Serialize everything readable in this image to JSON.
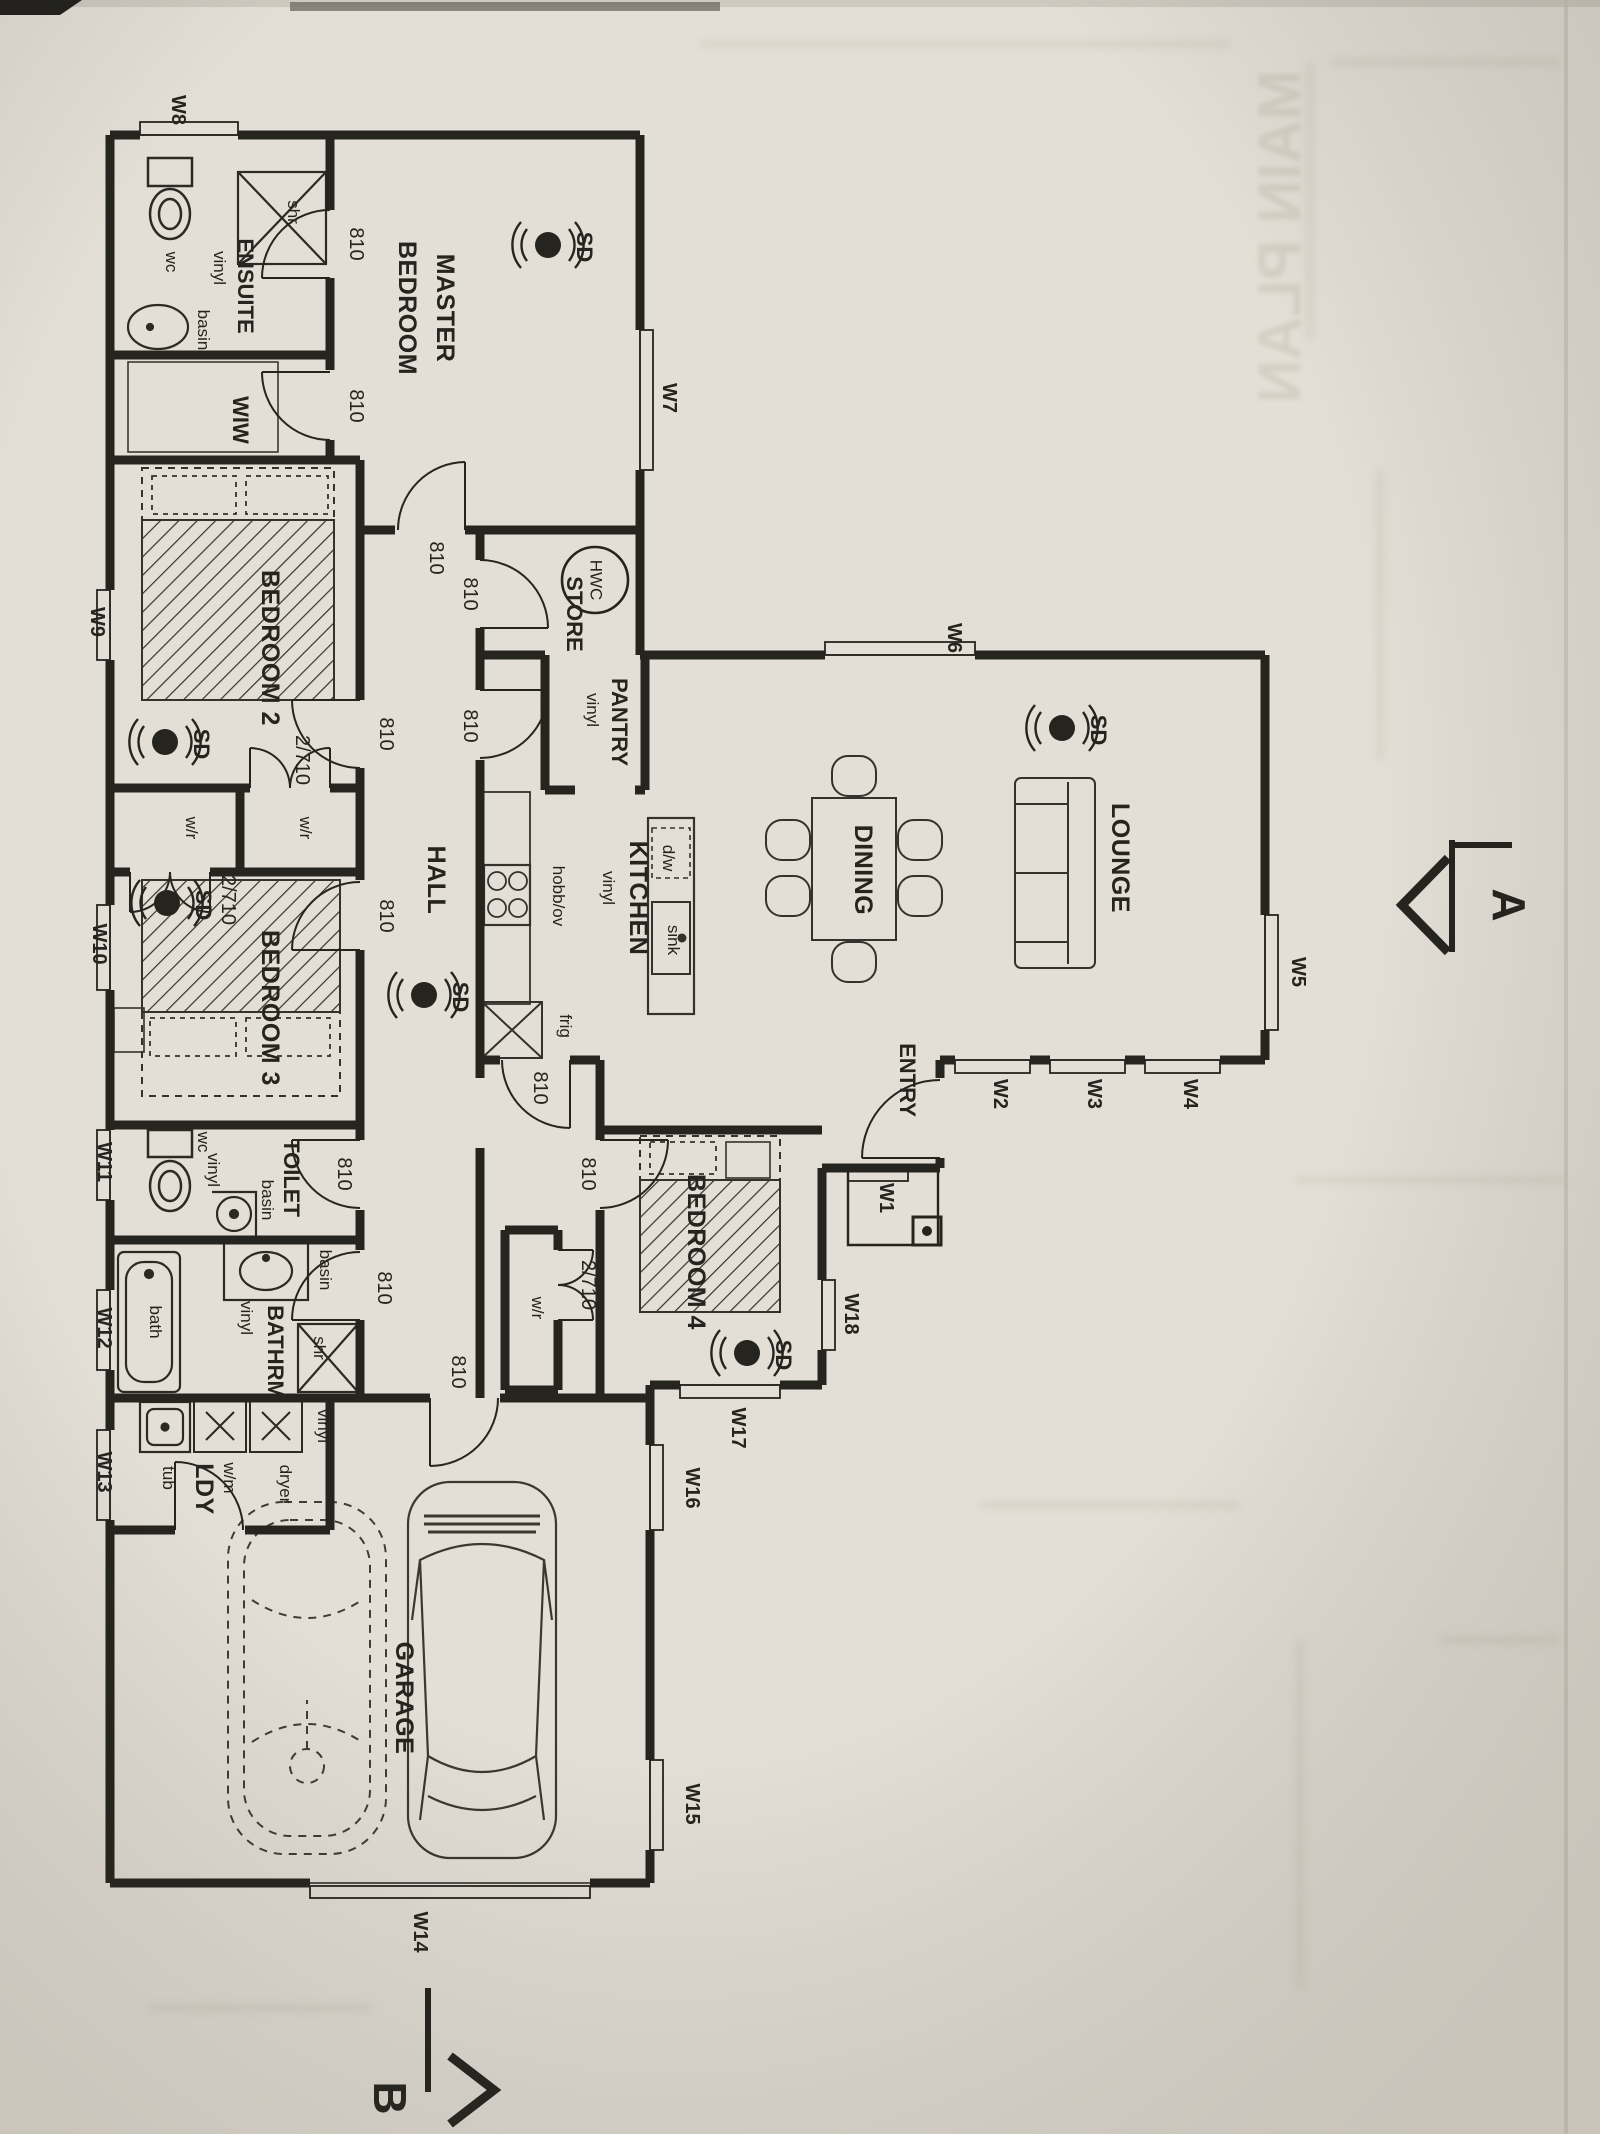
{
  "palette": {
    "paper": "#e4dfd6",
    "ink": "#26241f",
    "faint": "#c9c2b5"
  },
  "ghost": {
    "bleed_through_title": "MAIN PLAN"
  },
  "rooms": {
    "master": {
      "line1": "MASTER",
      "line2": "BEDROOM"
    },
    "ensuite": {
      "name": "ENSUITE",
      "floor": "vinyl"
    },
    "wiw": {
      "name": "WIW"
    },
    "bedroom2": {
      "name": "BEDROOM 2"
    },
    "bedroom3": {
      "name": "BEDROOM 3"
    },
    "bedroom4": {
      "name": "BEDROOM 4"
    },
    "hall": {
      "name": "HALL"
    },
    "store": {
      "name": "STORE"
    },
    "pantry": {
      "name": "PANTRY",
      "floor": "vinyl"
    },
    "kitchen": {
      "name": "KITCHEN",
      "floor": "vinyl"
    },
    "dining": {
      "name": "DINING"
    },
    "lounge": {
      "name": "LOUNGE"
    },
    "entry": {
      "name": "ENTRY"
    },
    "toilet": {
      "name": "TOILET",
      "floor": "vinyl"
    },
    "bathroom": {
      "name": "BATHRM",
      "floor": "vinyl"
    },
    "laundry": {
      "name": "LDY",
      "floor": "vinyl"
    },
    "garage": {
      "name": "GARAGE"
    }
  },
  "fixtures": {
    "wc": "wc",
    "basin": "basin",
    "shower": "shr",
    "bath": "bath",
    "tub": "tub",
    "washing_machine": "w/m",
    "dryer": "dryer",
    "hot_water_cylinder": "HWC",
    "hob_oven": "hobb/ov",
    "dishwasher": "d/w",
    "sink": "sink",
    "fridge": "frig",
    "wardrobe": "w/r"
  },
  "doors": {
    "standard": "810",
    "wardrobe_double": "2/710"
  },
  "smoke_detector_label": "SD",
  "windows": {
    "w1": "W1",
    "w2": "W2",
    "w3": "W3",
    "w4": "W4",
    "w5": "W5",
    "w6": "W6",
    "w7": "W7",
    "w8": "W8",
    "w9": "W9",
    "w10": "W10",
    "w11": "W11",
    "w12": "W12",
    "w13": "W13",
    "w14": "W14",
    "w15": "W15",
    "w16": "W16",
    "w17": "W17",
    "w18": "W18"
  },
  "section_markers": {
    "a": "A",
    "b": "B"
  }
}
